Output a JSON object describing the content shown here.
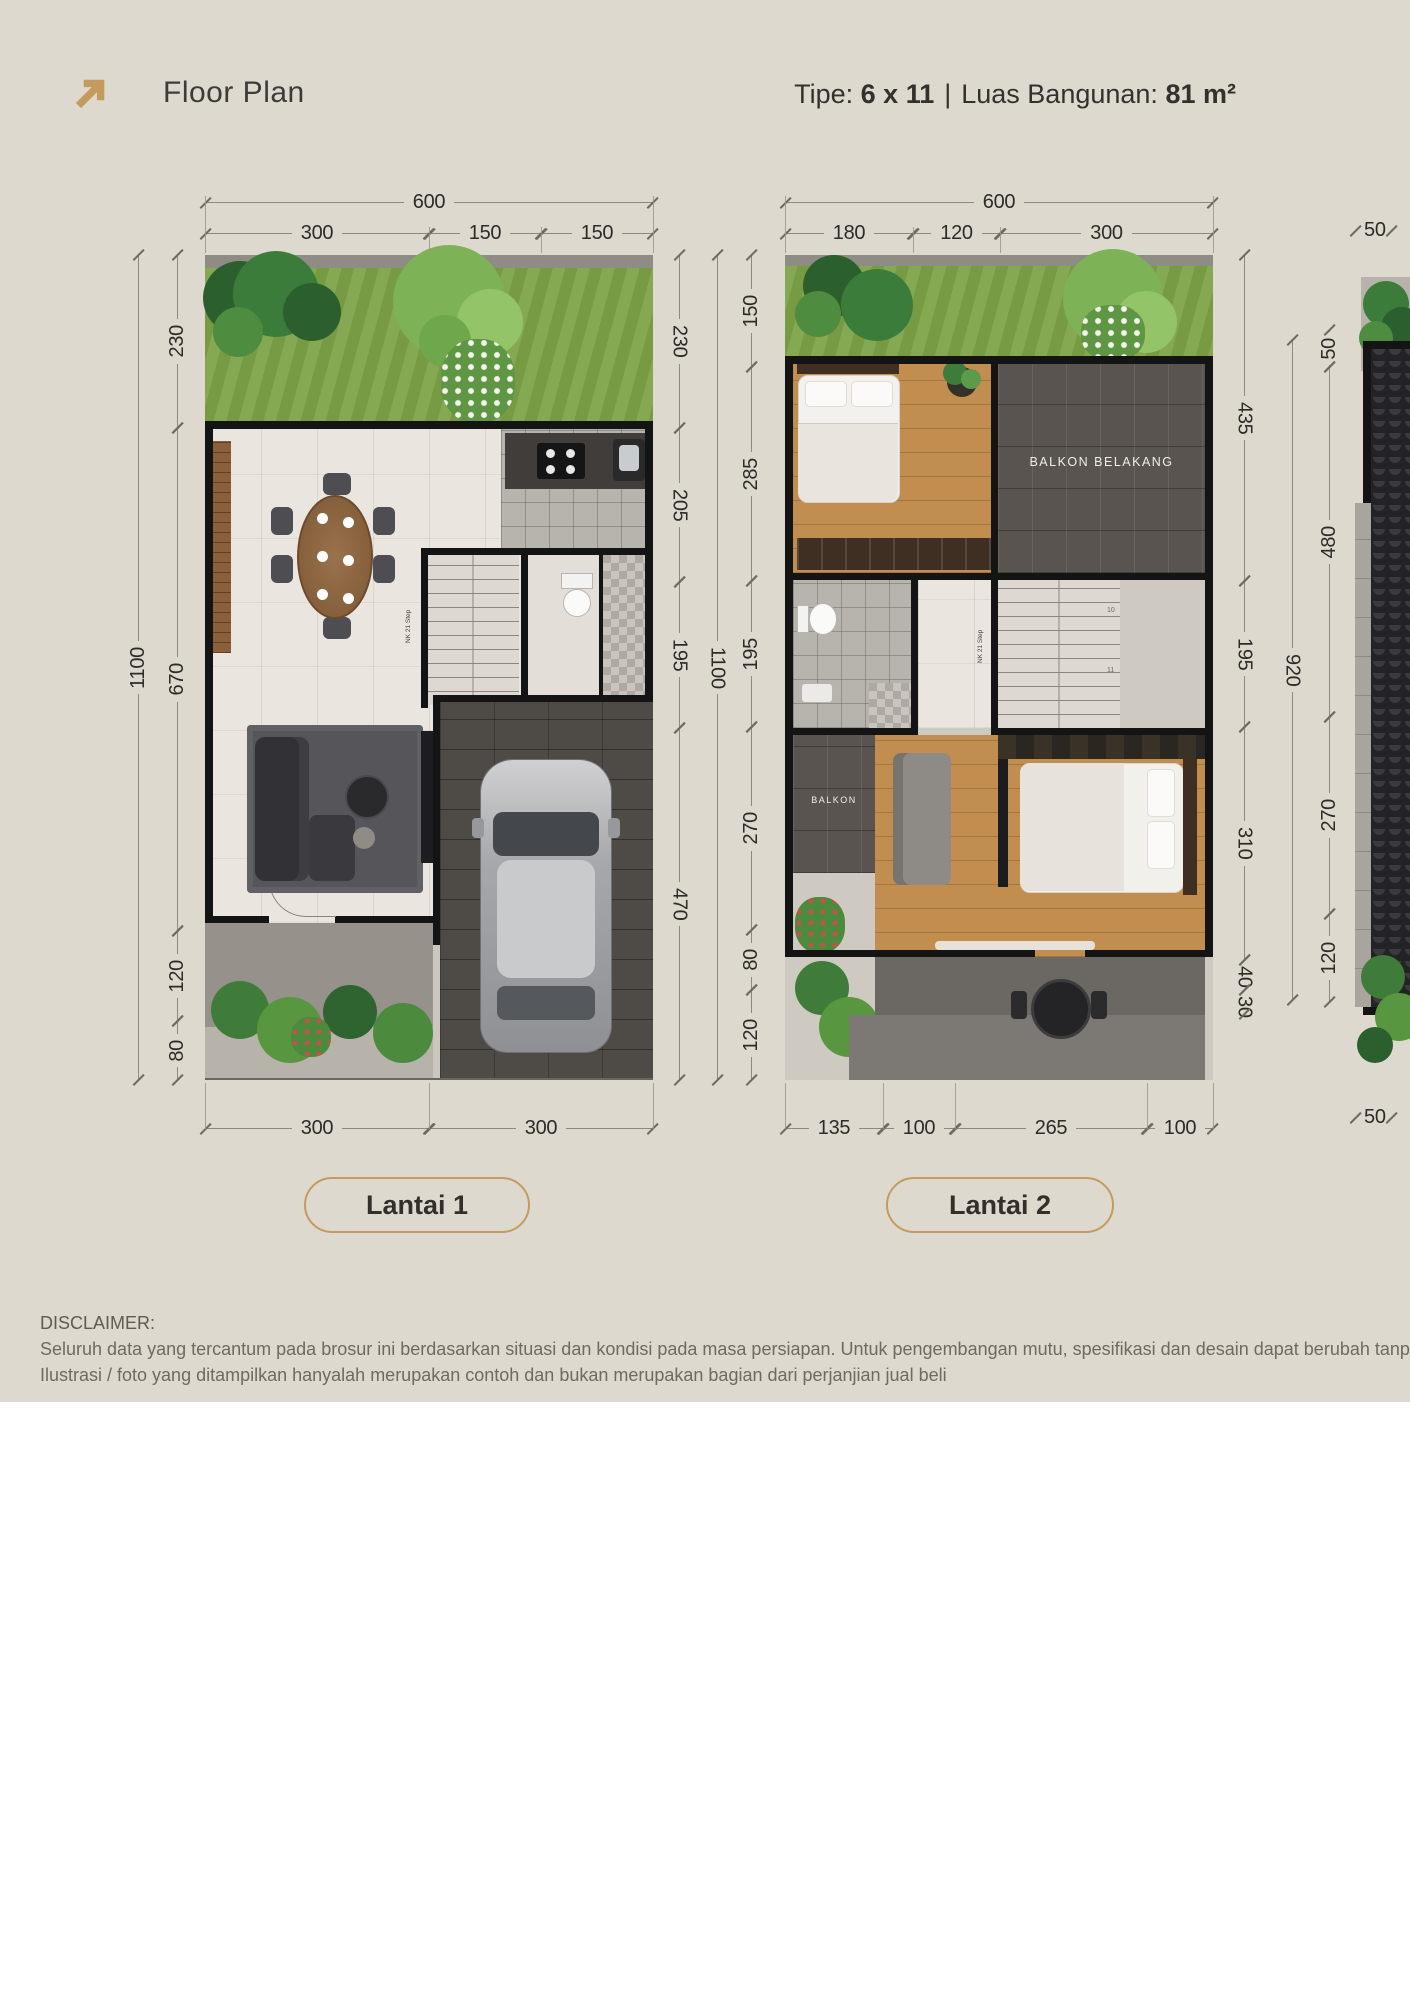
{
  "header": {
    "title": "Floor Plan",
    "icon": "arrow-up-right-icon",
    "spec": {
      "type_label": "Tipe:",
      "type_value": "6 x 11",
      "divider": "|",
      "area_label": "Luas Bangunan:",
      "area_value": "81 m²"
    }
  },
  "colors": {
    "background": "#ded9ce",
    "accent_gold": "#c49a5f",
    "wall": "#141414",
    "grass": "#7ca346",
    "dim_text": "#2c2b28"
  },
  "floor1": {
    "badge": "Lantai 1",
    "dims": {
      "top_total": "600",
      "top_segments": [
        "300",
        "150",
        "150"
      ],
      "left_outer": "1100",
      "left_segments": [
        "230",
        "670",
        "120",
        "80"
      ],
      "right_segments": [
        "230",
        "205",
        "195",
        "470"
      ],
      "right_outer": "1100",
      "bottom_segments": [
        "300",
        "300"
      ]
    },
    "labels": {
      "stairs_note": "NK 21 Step"
    }
  },
  "floor2": {
    "badge": "Lantai 2",
    "dims": {
      "top_total": "600",
      "top_segments": [
        "180",
        "120",
        "300"
      ],
      "left_segments": [
        "150",
        "285",
        "195",
        "270",
        "80",
        "120"
      ],
      "right_segments": [
        "435",
        "195",
        "310",
        "40",
        "30"
      ],
      "right_outer": "920",
      "bottom_segments": [
        "135",
        "100",
        "265",
        "100"
      ]
    },
    "labels": {
      "balcony_back": "BALKON BELAKANG",
      "balcony": "BALKON",
      "stairs_note": "NK 21 Step",
      "stair_numbers": [
        "10",
        "11"
      ]
    }
  },
  "floor3": {
    "dims": {
      "top": "50",
      "left_segments": [
        "50",
        "480",
        "270",
        "120"
      ],
      "bottom": "50"
    }
  },
  "disclaimer": {
    "heading": "DISCLAIMER:",
    "line1": "Seluruh data yang tercantum pada brosur ini berdasarkan situasi dan kondisi pada masa persiapan. Untuk pengembangan mutu, spesifikasi dan desain dapat berubah tanpa pemb",
    "line2": "Ilustrasi / foto yang ditampilkan hanyalah merupakan contoh dan bukan merupakan bagian dari perjanjian jual beli"
  }
}
